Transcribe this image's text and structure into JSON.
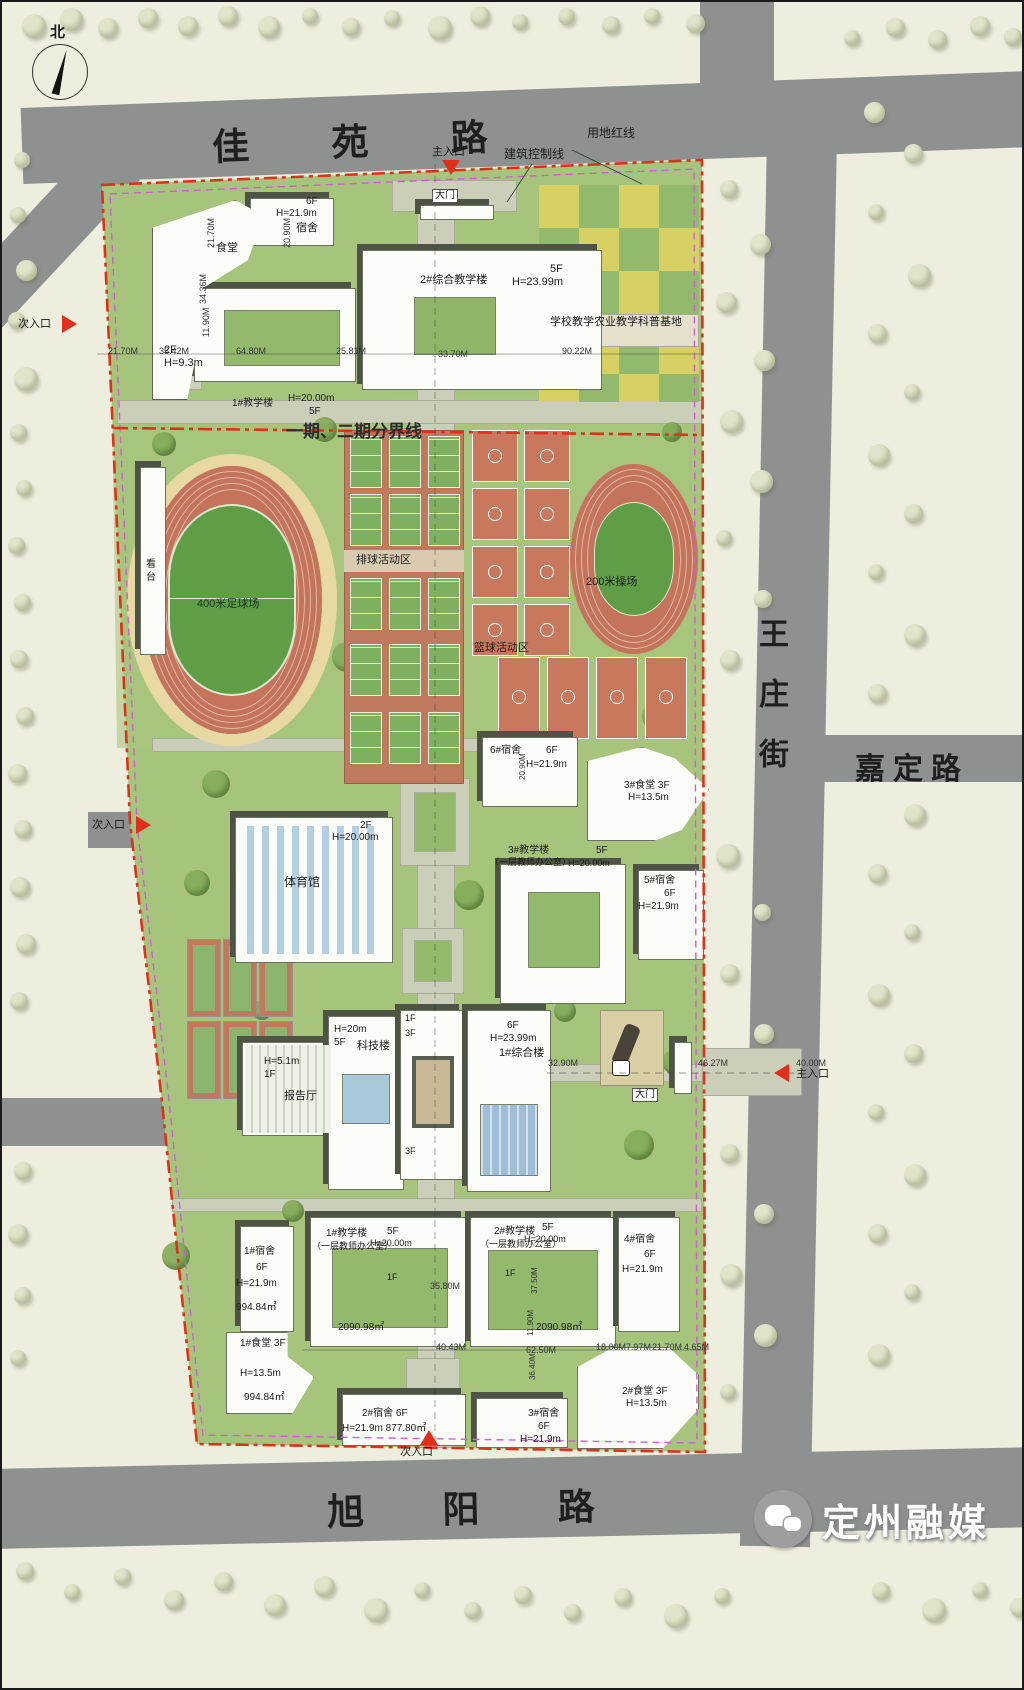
{
  "compass": {
    "north": "北"
  },
  "roads": {
    "top": "佳  苑  路",
    "right_vertical": "王庄街",
    "right_branch": "嘉定路",
    "bottom": "旭  阳  路"
  },
  "watermark": {
    "text": "定州融媒"
  },
  "labels": [
    {
      "n": "main-entrance-top-label",
      "t": "主入口",
      "x": 430,
      "y": 144,
      "s": 11
    },
    {
      "n": "control-line-label",
      "t": "建筑控制线",
      "x": 502,
      "y": 146,
      "s": 12
    },
    {
      "n": "land-red-line-label",
      "t": "用地红线",
      "x": 585,
      "y": 125,
      "s": 12
    },
    {
      "n": "gate-top-label",
      "t": "大门",
      "x": 430,
      "y": 187,
      "s": 10,
      "bg": 1
    },
    {
      "n": "secondary-entrance-topleft-label",
      "t": "次入口",
      "x": 16,
      "y": 316,
      "s": 11
    },
    {
      "n": "secondary-entrance-midleft-label",
      "t": "次入口",
      "x": 90,
      "y": 817,
      "s": 11
    },
    {
      "n": "secondary-entrance-bottom-label",
      "t": "次入口",
      "x": 398,
      "y": 1444,
      "s": 11
    },
    {
      "n": "main-entrance-right-label",
      "t": "主入口",
      "x": 794,
      "y": 1066,
      "s": 11
    },
    {
      "n": "gate-right-label",
      "t": "大门",
      "x": 630,
      "y": 1086,
      "s": 10,
      "bg": 1
    },
    {
      "n": "phase-boundary-label",
      "t": "一期、二期分界线",
      "x": 284,
      "y": 420,
      "s": 17,
      "b": 1,
      "c": "#2c2c2c"
    },
    {
      "n": "canteen-top-label",
      "t": "食堂",
      "x": 214,
      "y": 240,
      "s": 11
    },
    {
      "n": "canteen-top-floors",
      "t": "2F",
      "x": 162,
      "y": 342,
      "s": 11
    },
    {
      "n": "canteen-top-height",
      "t": "H=9.3m",
      "x": 162,
      "y": 355,
      "s": 11
    },
    {
      "n": "dorm-top-floors",
      "t": "6F",
      "x": 304,
      "y": 194,
      "s": 10
    },
    {
      "n": "dorm-top-height",
      "t": "H=21.9m",
      "x": 274,
      "y": 206,
      "s": 10
    },
    {
      "n": "dorm-top-label",
      "t": "宿舍",
      "x": 294,
      "y": 220,
      "s": 11
    },
    {
      "n": "teach1-top-label",
      "t": "1#教学楼",
      "x": 230,
      "y": 396,
      "s": 10
    },
    {
      "n": "teach1-top-height",
      "t": "H=20.00m",
      "x": 286,
      "y": 391,
      "s": 10
    },
    {
      "n": "teach1-top-floors",
      "t": "5F",
      "x": 307,
      "y": 404,
      "s": 10
    },
    {
      "n": "comp-teach2-label",
      "t": "2#综合教学楼",
      "x": 418,
      "y": 272,
      "s": 11
    },
    {
      "n": "comp-teach2-floors",
      "t": "5F",
      "x": 548,
      "y": 261,
      "s": 11
    },
    {
      "n": "comp-teach2-height",
      "t": "H=23.99m",
      "x": 510,
      "y": 274,
      "s": 11
    },
    {
      "n": "agri-base-label",
      "t": "学校教学农业教学科普基地",
      "x": 548,
      "y": 314,
      "s": 11
    },
    {
      "n": "dim-90-22",
      "t": "90.22M",
      "x": 560,
      "y": 344,
      "s": 9,
      "c": "#333"
    },
    {
      "n": "dim-21-70-a",
      "t": "21.70M",
      "x": 106,
      "y": 344,
      "s": 9,
      "c": "#333"
    },
    {
      "n": "dim-35-42",
      "t": "35.42M",
      "x": 157,
      "y": 344,
      "s": 9,
      "c": "#333"
    },
    {
      "n": "dim-64-80",
      "t": "64.80M",
      "x": 234,
      "y": 344,
      "s": 9,
      "c": "#333"
    },
    {
      "n": "dim-25-81",
      "t": "25.81M",
      "x": 334,
      "y": 344,
      "s": 9,
      "c": "#333"
    },
    {
      "n": "dim-33-70",
      "t": "33.70M",
      "x": 436,
      "y": 347,
      "s": 9,
      "c": "#333"
    },
    {
      "n": "dim-21-70-v",
      "t": "21.70M",
      "x": 204,
      "y": 246,
      "s": 9,
      "r": -90,
      "c": "#333"
    },
    {
      "n": "dim-20-90-v",
      "t": "20.90M",
      "x": 280,
      "y": 246,
      "s": 9,
      "r": -90,
      "c": "#333"
    },
    {
      "n": "dim-34-36-v",
      "t": "34.36M",
      "x": 196,
      "y": 302,
      "s": 9,
      "r": -90,
      "c": "#333"
    },
    {
      "n": "dim-11-90-v",
      "t": "11.90M",
      "x": 199,
      "y": 335,
      "s": 9,
      "r": -90,
      "c": "#333"
    },
    {
      "n": "grandstand-label",
      "t": "看台",
      "x": 141,
      "y": 556,
      "s": 10,
      "v": 1
    },
    {
      "n": "football-field-label",
      "t": "400米足球场",
      "x": 195,
      "y": 596,
      "s": 11,
      "c": "#15380f"
    },
    {
      "n": "volleyball-area-label",
      "t": "排球活动区",
      "x": 354,
      "y": 552,
      "s": 11
    },
    {
      "n": "basketball-area-label",
      "t": "篮球活动区",
      "x": 472,
      "y": 640,
      "s": 11
    },
    {
      "n": "track200-label",
      "t": "200米操场",
      "x": 584,
      "y": 574,
      "s": 11
    },
    {
      "n": "dorm6-label",
      "t": "6#宿舍",
      "x": 488,
      "y": 743,
      "s": 10
    },
    {
      "n": "dorm6-floors",
      "t": "6F",
      "x": 544,
      "y": 743,
      "s": 10
    },
    {
      "n": "dorm6-height",
      "t": "H=21.9m",
      "x": 524,
      "y": 757,
      "s": 10
    },
    {
      "n": "dim-20-90-vb",
      "t": "20.90M",
      "x": 516,
      "y": 778,
      "s": 8,
      "r": -90,
      "c": "#333"
    },
    {
      "n": "canteen3-label",
      "t": "3#食堂 3F",
      "x": 622,
      "y": 778,
      "s": 10
    },
    {
      "n": "canteen3-height",
      "t": "H=13.5m",
      "x": 626,
      "y": 790,
      "s": 10
    },
    {
      "n": "gym-floors",
      "t": "2F",
      "x": 358,
      "y": 818,
      "s": 10
    },
    {
      "n": "gym-height",
      "t": "H=20.00m",
      "x": 330,
      "y": 830,
      "s": 10
    },
    {
      "n": "gym-label",
      "t": "体育馆",
      "x": 282,
      "y": 874,
      "s": 12
    },
    {
      "n": "teach3-label",
      "t": "3#教学楼",
      "x": 506,
      "y": 843,
      "s": 10
    },
    {
      "n": "teach3-note",
      "t": "（一层教师办公室）",
      "x": 488,
      "y": 855,
      "s": 9
    },
    {
      "n": "teach3-floors",
      "t": "5F",
      "x": 594,
      "y": 843,
      "s": 10
    },
    {
      "n": "teach3-height",
      "t": "H=20.00m",
      "x": 566,
      "y": 856,
      "s": 9
    },
    {
      "n": "dorm5-label",
      "t": "5#宿舍",
      "x": 642,
      "y": 873,
      "s": 10
    },
    {
      "n": "dorm5-floors",
      "t": "6F",
      "x": 662,
      "y": 886,
      "s": 10
    },
    {
      "n": "dorm5-height",
      "t": "H=21.9m",
      "x": 636,
      "y": 899,
      "s": 10
    },
    {
      "n": "scitech-height",
      "t": "H=20m",
      "x": 332,
      "y": 1022,
      "s": 10
    },
    {
      "n": "scitech-floors",
      "t": "5F",
      "x": 332,
      "y": 1035,
      "s": 10
    },
    {
      "n": "scitech-label",
      "t": "科技楼",
      "x": 355,
      "y": 1038,
      "s": 11
    },
    {
      "n": "central-tower-1f",
      "t": "1F",
      "x": 403,
      "y": 1011,
      "s": 9
    },
    {
      "n": "central-tower-3f",
      "t": "3F",
      "x": 403,
      "y": 1026,
      "s": 9
    },
    {
      "n": "comp1-floors",
      "t": "6F",
      "x": 505,
      "y": 1018,
      "s": 10
    },
    {
      "n": "comp1-height",
      "t": "H=23.99m",
      "x": 488,
      "y": 1031,
      "s": 10
    },
    {
      "n": "comp1-label",
      "t": "1#综合楼",
      "x": 497,
      "y": 1045,
      "s": 11
    },
    {
      "n": "lecture-height",
      "t": "H=5.1m",
      "x": 262,
      "y": 1054,
      "s": 10
    },
    {
      "n": "lecture-floors",
      "t": "1F",
      "x": 262,
      "y": 1067,
      "s": 10
    },
    {
      "n": "lecture-label",
      "t": "报告厅",
      "x": 282,
      "y": 1088,
      "s": 11
    },
    {
      "n": "central-tower-3f-low",
      "t": "3F",
      "x": 403,
      "y": 1144,
      "s": 9
    },
    {
      "n": "dim-32-90",
      "t": "32.90M",
      "x": 546,
      "y": 1056,
      "s": 9,
      "c": "#333"
    },
    {
      "n": "dim-46-27",
      "t": "46.27M",
      "x": 696,
      "y": 1056,
      "s": 9,
      "c": "#333"
    },
    {
      "n": "dim-40-00",
      "t": "40.00M",
      "x": 794,
      "y": 1056,
      "s": 9,
      "c": "#333"
    },
    {
      "n": "dorm1-label",
      "t": "1#宿舍",
      "x": 242,
      "y": 1244,
      "s": 10
    },
    {
      "n": "dorm1-floors",
      "t": "6F",
      "x": 254,
      "y": 1260,
      "s": 10
    },
    {
      "n": "dorm1-height",
      "t": "H=21.9m",
      "x": 234,
      "y": 1276,
      "s": 10
    },
    {
      "n": "dorm1-area",
      "t": "994.84㎡",
      "x": 234,
      "y": 1300,
      "s": 10
    },
    {
      "n": "teach1b-label",
      "t": "1#教学楼",
      "x": 324,
      "y": 1226,
      "s": 10
    },
    {
      "n": "teach1b-note",
      "t": "（一层教师办公室）",
      "x": 310,
      "y": 1239,
      "s": 9
    },
    {
      "n": "teach1b-floors",
      "t": "5F",
      "x": 385,
      "y": 1224,
      "s": 10
    },
    {
      "n": "teach1b-height",
      "t": "H=20.00m",
      "x": 368,
      "y": 1236,
      "s": 9
    },
    {
      "n": "teach1b-1f",
      "t": "1F",
      "x": 385,
      "y": 1270,
      "s": 9
    },
    {
      "n": "teach1b-area",
      "t": "2090.98㎡",
      "x": 336,
      "y": 1320,
      "s": 10
    },
    {
      "n": "teach2b-label",
      "t": "2#教学楼",
      "x": 492,
      "y": 1224,
      "s": 10
    },
    {
      "n": "teach2b-note",
      "t": "（一层教师办公室）",
      "x": 478,
      "y": 1237,
      "s": 9
    },
    {
      "n": "teach2b-floors",
      "t": "5F",
      "x": 540,
      "y": 1220,
      "s": 10
    },
    {
      "n": "teach2b-height",
      "t": "H=20.00m",
      "x": 522,
      "y": 1232,
      "s": 9
    },
    {
      "n": "teach2b-1f",
      "t": "1F",
      "x": 503,
      "y": 1266,
      "s": 9
    },
    {
      "n": "teach2b-area",
      "t": "2090.98㎡",
      "x": 534,
      "y": 1320,
      "s": 10
    },
    {
      "n": "dorm4-label",
      "t": "4#宿舍",
      "x": 622,
      "y": 1232,
      "s": 10
    },
    {
      "n": "dorm4-floors",
      "t": "6F",
      "x": 642,
      "y": 1247,
      "s": 10
    },
    {
      "n": "dorm4-height",
      "t": "H=21.9m",
      "x": 620,
      "y": 1262,
      "s": 10
    },
    {
      "n": "dim-35-80",
      "t": "35.80M",
      "x": 428,
      "y": 1279,
      "s": 9,
      "c": "#333"
    },
    {
      "n": "dim-40-43",
      "t": "40.43M",
      "x": 434,
      "y": 1340,
      "s": 9,
      "c": "#333"
    },
    {
      "n": "dim-62-50",
      "t": "62.50M",
      "x": 524,
      "y": 1343,
      "s": 9,
      "c": "#333"
    },
    {
      "n": "dim-18-00",
      "t": "18.00M",
      "x": 594,
      "y": 1340,
      "s": 9,
      "c": "#333"
    },
    {
      "n": "dim-7-97",
      "t": "7.97M",
      "x": 624,
      "y": 1340,
      "s": 9,
      "c": "#333"
    },
    {
      "n": "dim-21-70-b",
      "t": "21.70M",
      "x": 650,
      "y": 1340,
      "s": 9,
      "c": "#333"
    },
    {
      "n": "dim-4-65",
      "t": "4.65M",
      "x": 682,
      "y": 1340,
      "s": 9,
      "c": "#333"
    },
    {
      "n": "dim-37-50-v",
      "t": "37.50M",
      "x": 528,
      "y": 1292,
      "s": 8,
      "r": -90,
      "c": "#333"
    },
    {
      "n": "dim-11-90-vb",
      "t": "11.90M",
      "x": 524,
      "y": 1334,
      "s": 8,
      "r": -90,
      "c": "#333"
    },
    {
      "n": "dim-36-40-v",
      "t": "36.40M",
      "x": 526,
      "y": 1378,
      "s": 8,
      "r": -90,
      "c": "#333"
    },
    {
      "n": "dorm2-label",
      "t": "2#宿舍  6F",
      "x": 360,
      "y": 1406,
      "s": 10
    },
    {
      "n": "dorm2-height-area",
      "t": "H=21.9m  877.80㎡",
      "x": 340,
      "y": 1421,
      "s": 10
    },
    {
      "n": "dorm3-label",
      "t": "3#宿舍",
      "x": 526,
      "y": 1406,
      "s": 10
    },
    {
      "n": "dorm3-floors",
      "t": "6F",
      "x": 536,
      "y": 1419,
      "s": 10
    },
    {
      "n": "dorm3-height",
      "t": "H=21.9m",
      "x": 518,
      "y": 1432,
      "s": 10
    },
    {
      "n": "canteen2-label",
      "t": "2#食堂 3F",
      "x": 620,
      "y": 1384,
      "s": 10
    },
    {
      "n": "canteen2-height",
      "t": "H=13.5m",
      "x": 624,
      "y": 1396,
      "s": 10
    },
    {
      "n": "canteen1b-label",
      "t": "1#食堂 3F",
      "x": 238,
      "y": 1336,
      "s": 10
    },
    {
      "n": "canteen1b-height",
      "t": "H=13.5m",
      "x": 238,
      "y": 1366,
      "s": 10
    },
    {
      "n": "canteen1b-area",
      "t": "994.84㎡",
      "x": 242,
      "y": 1390,
      "s": 10
    }
  ]
}
